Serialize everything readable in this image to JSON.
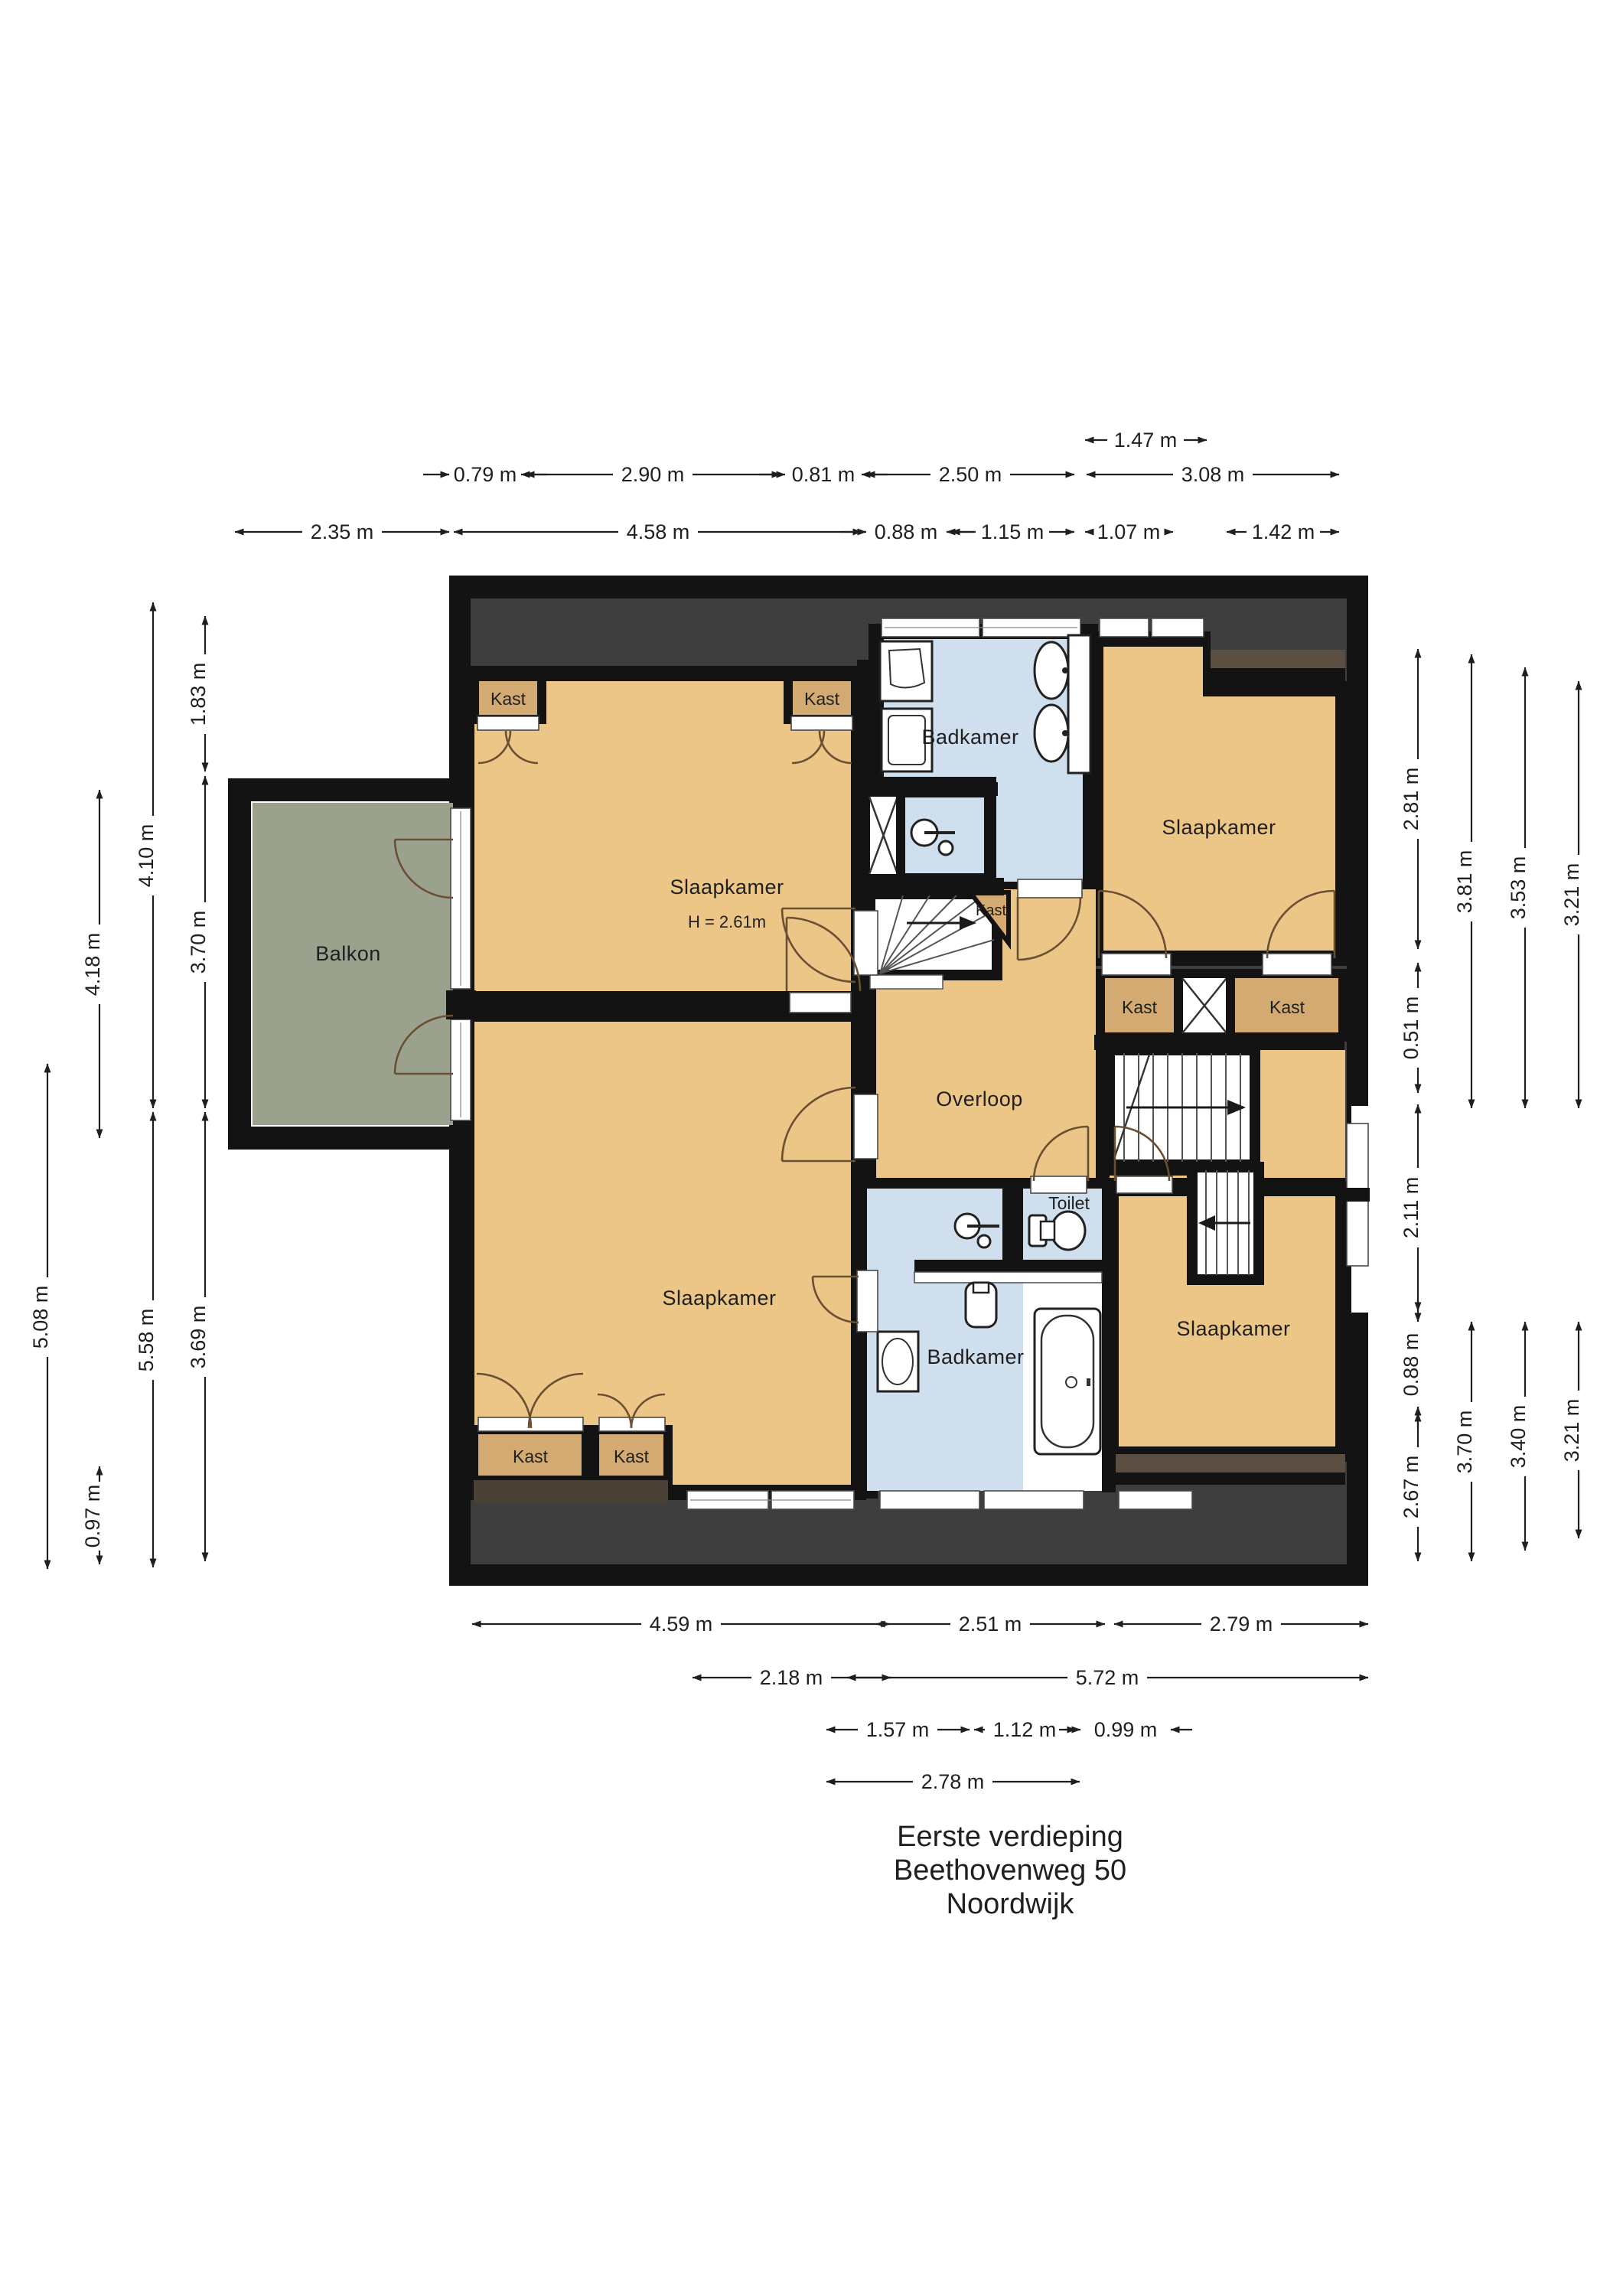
{
  "title": {
    "line1": "Eerste verdieping",
    "line2": "Beethovenweg 50",
    "line3": "Noordwijk"
  },
  "labels": {
    "slaapkamer": "Slaapkamer",
    "ceiling_height": "H = 2.61m",
    "badkamer": "Badkamer",
    "toilet": "Toilet",
    "overloop": "Overloop",
    "balkon": "Balkon",
    "kast": "Kast"
  },
  "dims": {
    "top_row1": [
      "1.47 m"
    ],
    "top_row2": [
      "0.79 m",
      "2.90 m",
      "0.81 m",
      "2.50 m",
      "3.08 m"
    ],
    "top_row3": [
      "2.35 m",
      "4.58 m",
      "0.88 m",
      "1.15 m",
      "1.07 m",
      "1.42 m"
    ],
    "bottom_row1": [
      "4.59 m",
      "2.51 m",
      "2.79 m"
    ],
    "bottom_row2": [
      "2.18 m",
      "5.72 m"
    ],
    "bottom_row3": [
      "1.57 m",
      "1.12 m",
      "0.99 m"
    ],
    "bottom_row4": [
      "2.78 m"
    ],
    "left_col1": [
      "5.08 m"
    ],
    "left_col2": [
      "4.18 m",
      "0.97 m"
    ],
    "left_col3": [
      "4.10 m",
      "5.58 m"
    ],
    "left_col4": [
      "1.83 m",
      "3.70 m",
      "3.69 m"
    ],
    "right_col1": [
      "2.81 m",
      "0.51 m",
      "2.11 m",
      "0.88 m",
      "2.67 m"
    ],
    "right_col2": [
      "3.81 m",
      "3.70 m"
    ],
    "right_col3": [
      "3.53 m",
      "3.40 m"
    ],
    "right_col4": [
      "3.21 m",
      "3.21 m"
    ]
  },
  "colors": {
    "room_fill": "#ecc687",
    "closet_fill": "#d3ab72",
    "bathroom_fill": "#cfdfee",
    "balcony_fill": "#9aa28e",
    "roof_dark": "#3e3e3e",
    "roof_brown": "#5a4f42",
    "wall": "#131313"
  }
}
